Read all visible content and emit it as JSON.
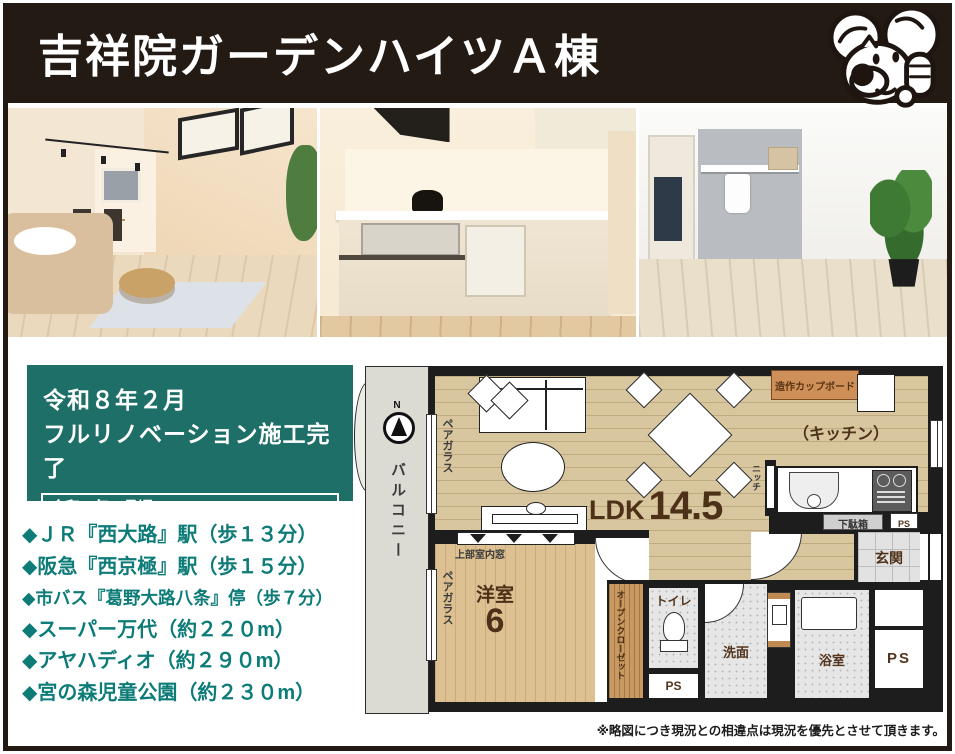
{
  "header": {
    "title": "吉祥院ガーデンハイツＡ棟"
  },
  "renovation": {
    "line1": "令和８年２月",
    "line2": "フルリノベーション施工完了",
    "note1": "令和８年４月頃",
    "note2": "バルコニー側窓のアルミサッシ交換予定"
  },
  "locations": {
    "items": [
      "◆ＪＲ『西大路』駅（歩１３分）",
      "◆阪急『西京極』駅（歩１５分）",
      "◆市バス『葛野大路八条』停（歩７分）",
      "◆スーパー万代（約２２０m）",
      "◆アヤハディオ（約２９０m）",
      "◆宮の森児童公園（約２３０m）"
    ]
  },
  "floorplan": {
    "compass_n": "N",
    "balcony": "バルコニー",
    "pair_glass": "ペアガラス",
    "upper_window": "上部室内窓",
    "ldk_label": "LDK",
    "ldk_size": "14.5",
    "kitchen": "（キッチン）",
    "cupboard": "造作カップボード",
    "niche": "ニッチ",
    "shoe_box": "下駄箱",
    "ps": "PS",
    "entrance": "玄関",
    "western_room": "洋室",
    "western_room_size": "6",
    "open_closet": "オープンクローゼット",
    "toilet": "トイレ",
    "washroom": "洗面",
    "bathroom": "浴室"
  },
  "disclaimer": "※略図につき現況との相違点は現況を優先とさせて頂きます。",
  "colors": {
    "header_bg": "#241a14",
    "teal_box": "#1f6f69",
    "location_text": "#0d7c78",
    "plan_text_brown": "#4c3018",
    "wood_floor": "#d8c69e"
  }
}
